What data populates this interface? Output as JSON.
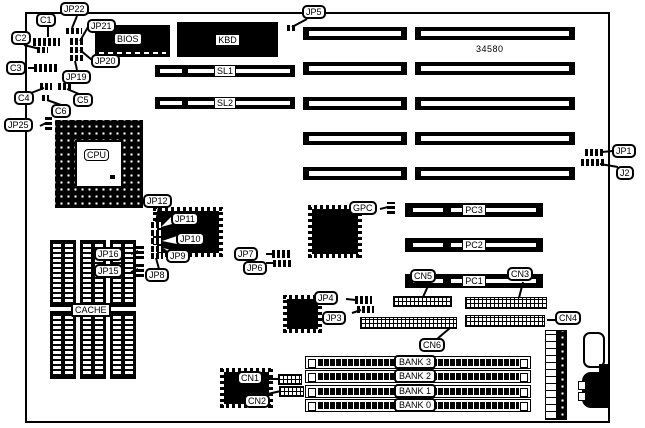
{
  "board": {
    "part_number": "34580"
  },
  "chips": {
    "cpu": "CPU",
    "bios": "BIOS",
    "kbd": "KBD",
    "cache": "CACHE"
  },
  "slots": {
    "sl1": "SL1",
    "sl2": "SL2",
    "pc1": "PC1",
    "pc2": "PC2",
    "pc3": "PC3"
  },
  "banks": {
    "b3": "BANK 3",
    "b2": "BANK 2",
    "b1": "BANK 1",
    "b0": "BANK 0"
  },
  "callouts": {
    "c1": "C1",
    "c2": "C2",
    "c3": "C3",
    "c4": "C4",
    "c5": "C5",
    "c6": "C6",
    "jp1": "JP1",
    "j2": "J2",
    "jp3": "JP3",
    "jp4": "JP4",
    "jp5": "JP5",
    "jp6": "JP6",
    "jp7": "JP7",
    "jp8": "JP8",
    "jp9": "JP9",
    "jp10": "JP10",
    "jp11": "JP11",
    "jp12": "JP12",
    "jp15": "JP15",
    "jp16": "JP16",
    "jp19": "JP19",
    "jp20": "JP20",
    "jp21": "JP21",
    "jp22": "JP22",
    "jp25": "JP25",
    "cn1": "CN1",
    "cn2": "CN2",
    "cn3": "CN3",
    "cn4": "CN4",
    "cn5": "CN5",
    "cn6": "CN6",
    "gpc": "GPC"
  }
}
